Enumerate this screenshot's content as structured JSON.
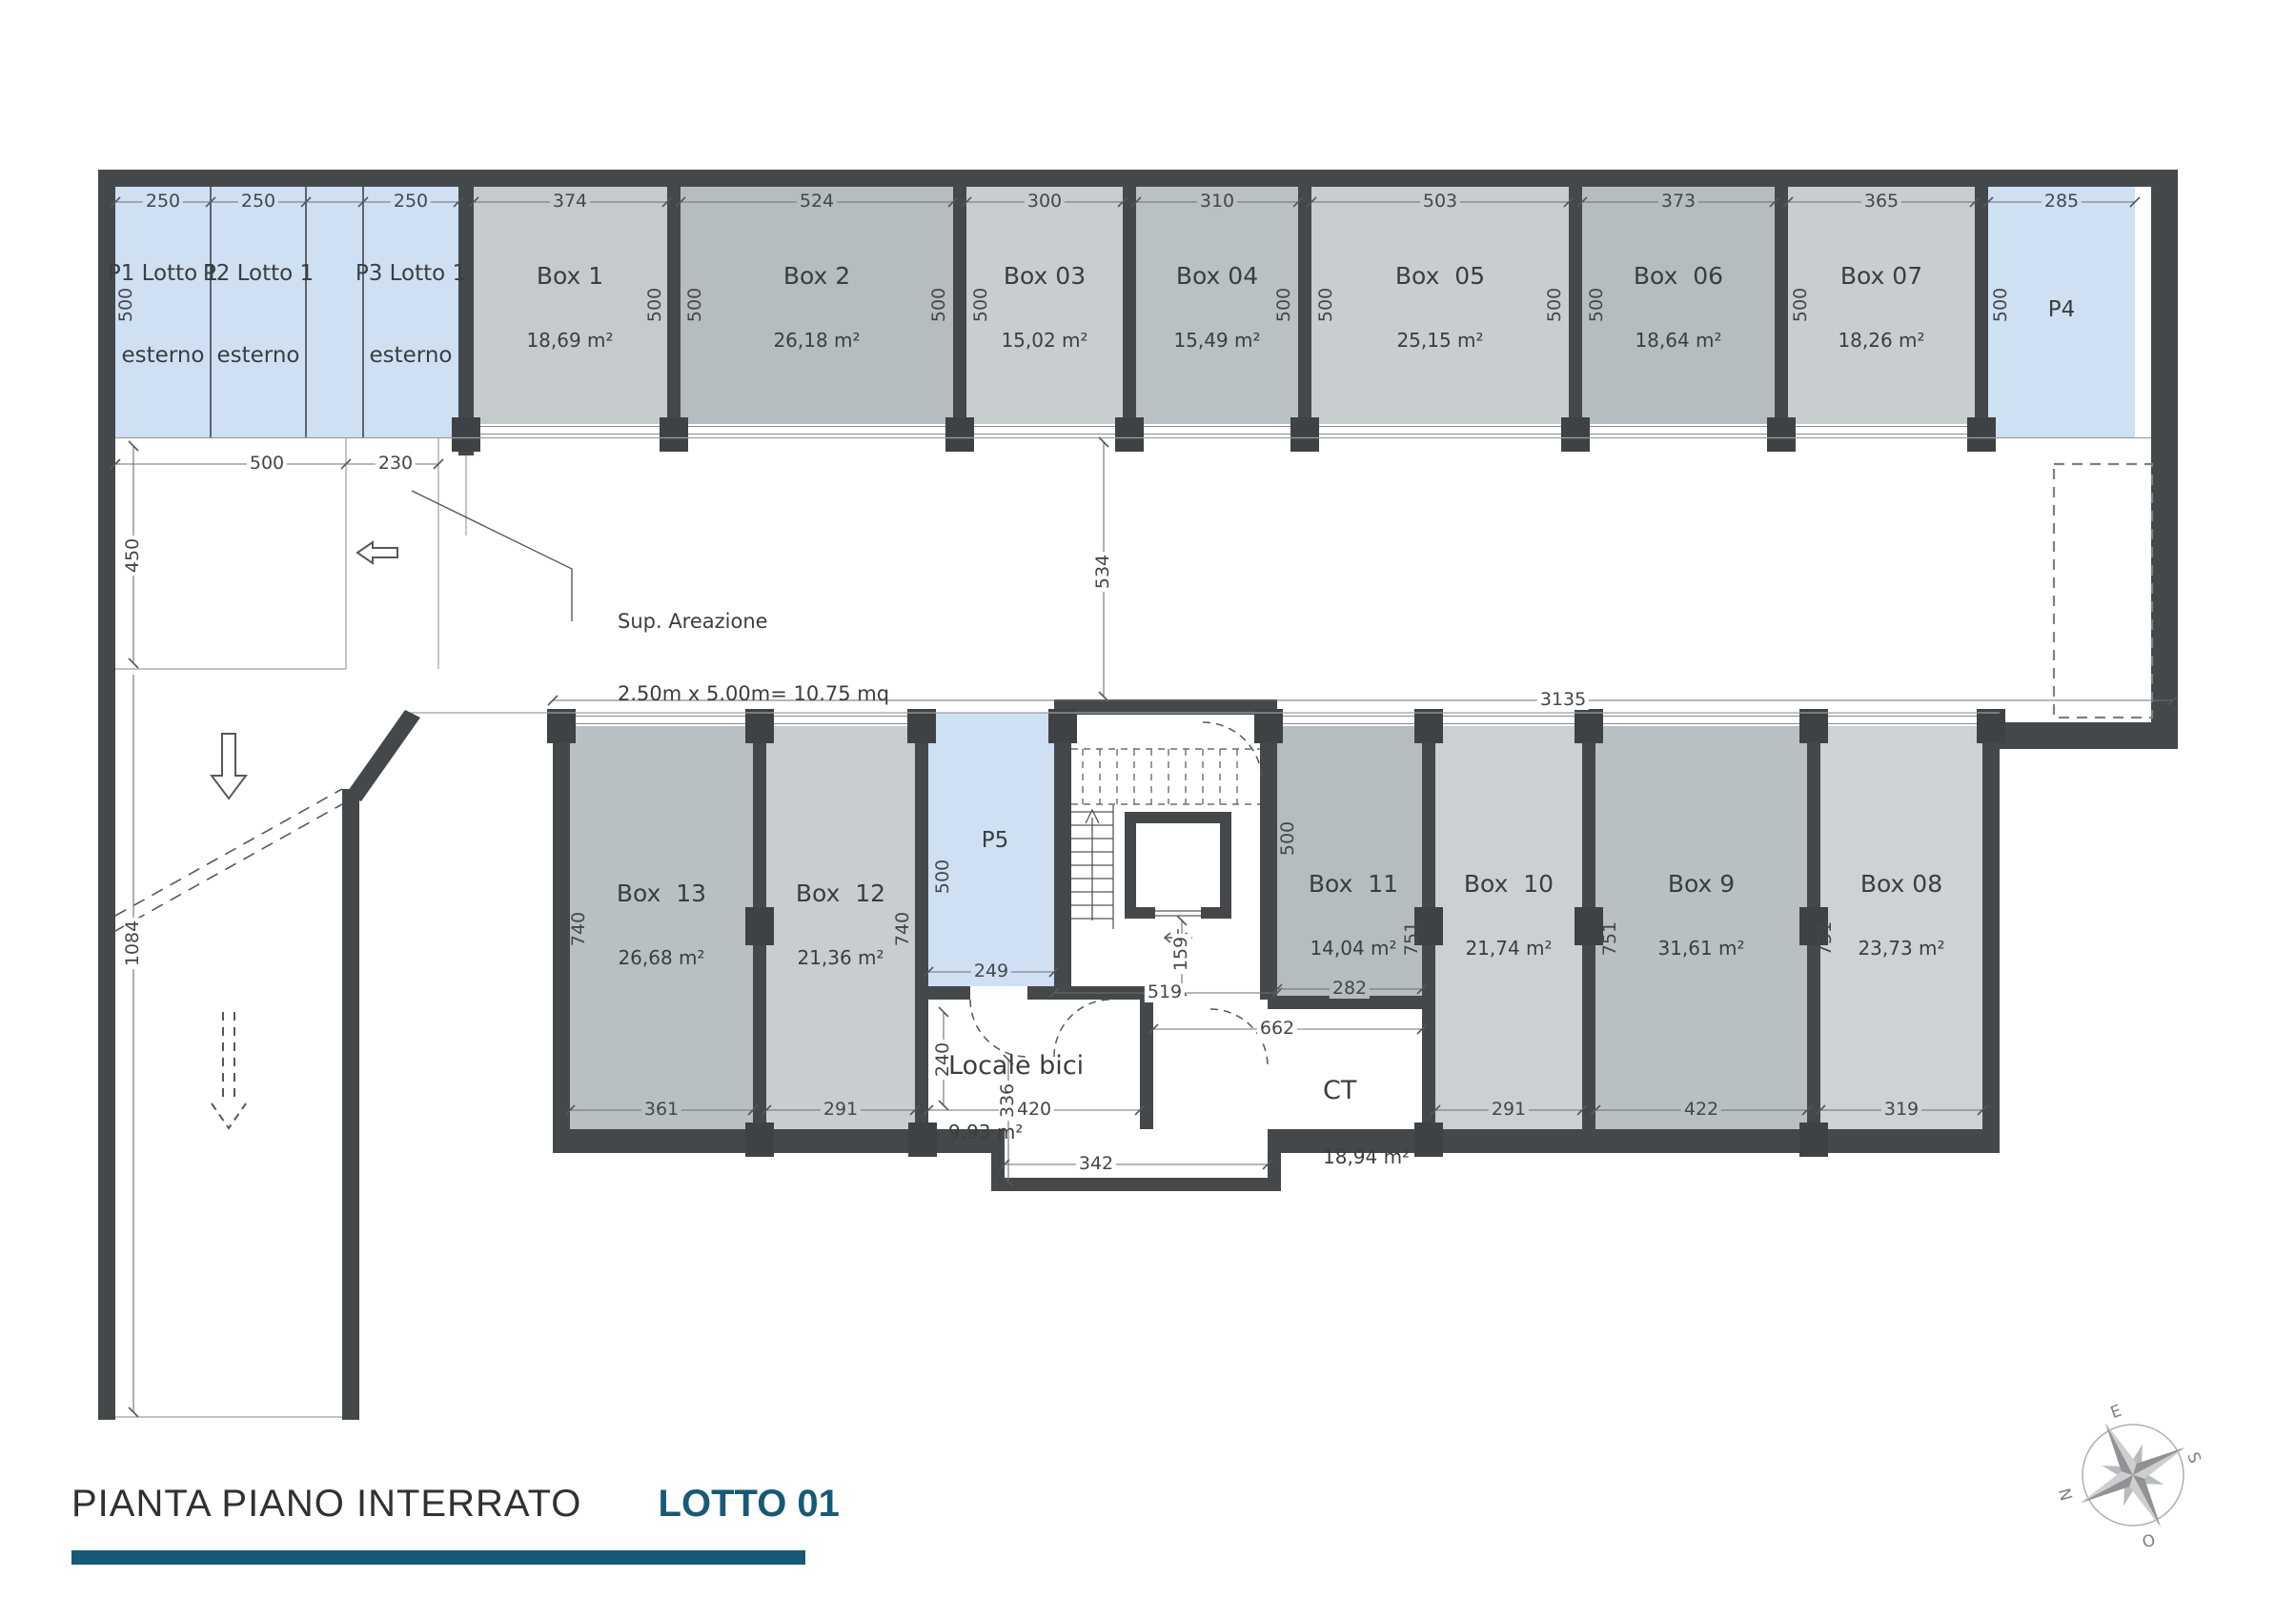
{
  "title": {
    "main": "PIANTA PIANO INTERRATO",
    "lot": "LOTTO 01"
  },
  "colors": {
    "wall": "#45484b",
    "parking_blue": "#cfe0f3",
    "accent": "#175a78"
  },
  "parking": {
    "p1": "P1 Lotto 1",
    "p1_sub": "esterno",
    "p2": "P2 Lotto 1",
    "p2_sub": "esterno",
    "p3": "P3 Lotto 1",
    "p3_sub": "esterno",
    "p4": "P4",
    "p5": "P5"
  },
  "boxes": {
    "b1": {
      "name": "Box 1",
      "area": "18,69 m²"
    },
    "b2": {
      "name": "Box 2",
      "area": "26,18 m²"
    },
    "b3": {
      "name": "Box 03",
      "area": "15,02 m²"
    },
    "b4": {
      "name": "Box 04",
      "area": "15,49 m²"
    },
    "b5": {
      "name": "Box  05",
      "area": "25,15 m²"
    },
    "b6": {
      "name": "Box  06",
      "area": "18,64 m²"
    },
    "b7": {
      "name": "Box 07",
      "area": "18,26 m²"
    },
    "b8": {
      "name": "Box 08",
      "area": "23,73 m²"
    },
    "b9": {
      "name": "Box 9",
      "area": "31,61 m²"
    },
    "b10": {
      "name": "Box  10",
      "area": "21,74 m²"
    },
    "b11": {
      "name": "Box  11",
      "area": "14,04 m²"
    },
    "b12": {
      "name": "Box  12",
      "area": "21,36 m²"
    },
    "b13": {
      "name": "Box  13",
      "area": "26,68 m²"
    }
  },
  "rooms": {
    "locale_bici": {
      "name": "Locale bici",
      "area": "9,93 m²"
    },
    "ct": {
      "name": "CT",
      "area": "18,94 m²"
    }
  },
  "annotation": {
    "line1": "Sup. Areazione",
    "line2": "2.50m x 5.00m= 10.75 mq"
  },
  "dims": {
    "d250": "250",
    "d374": "374",
    "d524": "524",
    "d300": "300",
    "d310": "310",
    "d503": "503",
    "d373": "373",
    "d365": "365",
    "d285": "285",
    "d500": "500",
    "d230": "230",
    "d450": "450",
    "d534": "534",
    "d3135": "3135",
    "d1084": "1084",
    "d740": "740",
    "d751": "751",
    "d249": "249",
    "d519": "519",
    "d159": "159",
    "d282": "282",
    "d291": "291",
    "d361": "361",
    "d420": "420",
    "d240": "240",
    "d336": "336",
    "d342": "342",
    "d422": "422",
    "d319": "319",
    "d662": "662"
  },
  "compass": {
    "n": "N",
    "e": "E",
    "s": "S",
    "o": "O"
  }
}
